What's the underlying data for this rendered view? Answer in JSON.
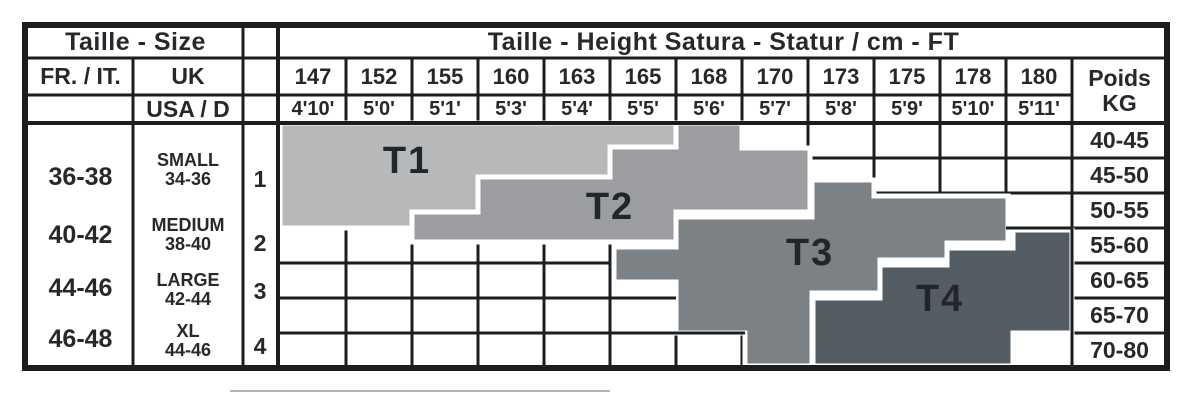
{
  "table": {
    "title_left": "Taille - Size",
    "title_right": "Taille - Height Satura - Statur / cm - FT",
    "col_headers": {
      "fr_it": "FR. / IT.",
      "uk": "UK",
      "usa_d": "USA / D",
      "poids_line1": "Poids",
      "poids_line2": "KG"
    },
    "heights_cm": [
      "147",
      "152",
      "155",
      "160",
      "163",
      "165",
      "168",
      "170",
      "173",
      "175",
      "178",
      "180"
    ],
    "heights_ft": [
      "4'10'",
      "5'0'",
      "5'1'",
      "5'3'",
      "5'4'",
      "5'5'",
      "5'6'",
      "5'7'",
      "5'8'",
      "5'9'",
      "5'10'",
      "5'11'"
    ],
    "size_rows": [
      {
        "fr_it": "36-38",
        "uk_name": "SMALL",
        "uk_range": "34-36",
        "usa_d": "1"
      },
      {
        "fr_it": "40-42",
        "uk_name": "MEDIUM",
        "uk_range": "38-40",
        "usa_d": "2"
      },
      {
        "fr_it": "44-46",
        "uk_name": "LARGE",
        "uk_range": "42-44",
        "usa_d": "3"
      },
      {
        "fr_it": "46-48",
        "uk_name": "XL",
        "uk_range": "44-46",
        "usa_d": "4"
      }
    ],
    "weights_kg": [
      "40-45",
      "45-50",
      "50-55",
      "55-60",
      "60-65",
      "65-70",
      "70-80"
    ],
    "bands": [
      {
        "label": "T1",
        "color": "#b6b8ba"
      },
      {
        "label": "T2",
        "color": "#9b9da0"
      },
      {
        "label": "T3",
        "color": "#7b8184"
      },
      {
        "label": "T4",
        "color": "#555d64"
      }
    ],
    "line_color": "#1b1d21",
    "separator_color": "#ffffff"
  },
  "chart_data": {
    "type": "heatmap",
    "title": "Taille - Height Satura - Statur / cm - FT",
    "xlabel": "Height (cm / ft)",
    "ylabel": "Poids KG",
    "x_categories_cm": [
      147,
      152,
      155,
      160,
      163,
      165,
      168,
      170,
      173,
      175,
      178,
      180
    ],
    "x_categories_ft": [
      "4'10'",
      "5'0'",
      "5'1'",
      "5'3'",
      "5'4'",
      "5'5'",
      "5'6'",
      "5'7'",
      "5'8'",
      "5'9'",
      "5'10'",
      "5'11'"
    ],
    "y_categories_kg": [
      "40-45",
      "45-50",
      "50-55",
      "55-60",
      "60-65",
      "65-70",
      "70-80"
    ],
    "grid": true,
    "legend_position": "none",
    "regions": [
      {
        "label": "T1",
        "fr_it": "36-38",
        "uk": "SMALL 34-36",
        "usa_d": "1",
        "heights_cm": "147-165",
        "weights_kg": "40-55",
        "shape": "stepped band, top-left"
      },
      {
        "label": "T2",
        "fr_it": "40-42",
        "uk": "MEDIUM 38-40",
        "usa_d": "2",
        "heights_cm": "152-173",
        "weights_kg": "40-60",
        "shape": "stepped band"
      },
      {
        "label": "T3",
        "fr_it": "44-46",
        "uk": "LARGE 42-44",
        "usa_d": "3",
        "heights_cm": "163-180",
        "weights_kg": "50-80",
        "shape": "stepped band"
      },
      {
        "label": "T4",
        "fr_it": "46-48",
        "uk": "XL 44-46",
        "usa_d": "4",
        "heights_cm": "170-180",
        "weights_kg": "50-80",
        "shape": "stepped band, bottom-right"
      }
    ]
  }
}
